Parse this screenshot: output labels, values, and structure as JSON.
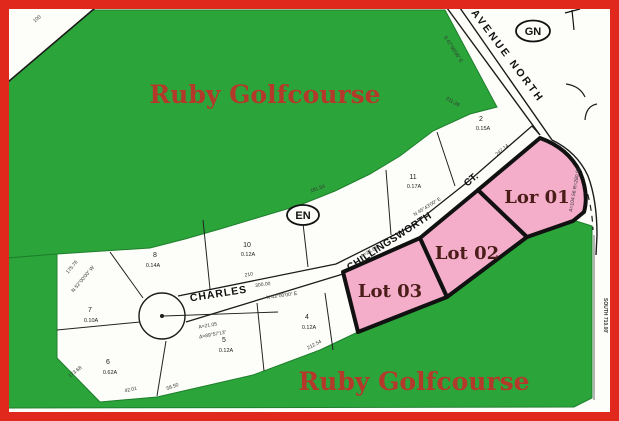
{
  "colors": {
    "border_red": "#e0281c",
    "golf_green": "#2ba43a",
    "lot_pink": "#f4aeca",
    "plat_white": "#fdfdfa",
    "lot_label_maroon": "#4a1d18",
    "ruby_red": "#b5392b",
    "line_black": "#1b1b1b"
  },
  "golfcourse": {
    "top": "Ruby Golfcourse",
    "bottom": "Ruby Golfcourse"
  },
  "highlighted_lots": {
    "lot1": "Lor 01",
    "lot2": "Lot 02",
    "lot3": "Lot 03"
  },
  "streets": {
    "avenue": "AVENUE  NORTH",
    "chillingsworth": "CHILLINGSWORTH",
    "ct": "CT.",
    "charles": "CHARLES"
  },
  "markers": {
    "gn": "GN",
    "en": "EN"
  },
  "parcels": {
    "p2": {
      "n": "2",
      "a": "0.15A"
    },
    "p11": {
      "n": "11",
      "a": "0.17A"
    },
    "p10": {
      "n": "10",
      "a": "0.12A"
    },
    "p8": {
      "n": "8",
      "a": "0.14A"
    },
    "p7": {
      "n": "7",
      "a": "0.10A"
    },
    "p6": {
      "n": "6",
      "a": "0.62A"
    },
    "p5": {
      "n": "5",
      "a": "0.12A"
    },
    "p4": {
      "n": "4",
      "a": "0.12A"
    }
  },
  "dims": {
    "d100": "100",
    "avbearing": "S 47°00'00\" E",
    "d21128": "211.28",
    "d18154": "181.54",
    "d24714": "247.14",
    "ctbearing": "N 45°43'00\" E",
    "a2166": "A=21.66",
    "d210": "210",
    "d30000": "300.00",
    "chbearing": "N 43°00'00\" E",
    "d17368": "173.68",
    "d4201": "42.01",
    "d5850": "58.50",
    "d21254": "212.54",
    "a2105": "A=21.05",
    "delta": "Δ=89°57'13\"",
    "curve": "A=104.56  R=280.00",
    "south": "SOUTH   710.00'",
    "b17576": "175.76",
    "b5200": "N 52°00'00\" W"
  }
}
